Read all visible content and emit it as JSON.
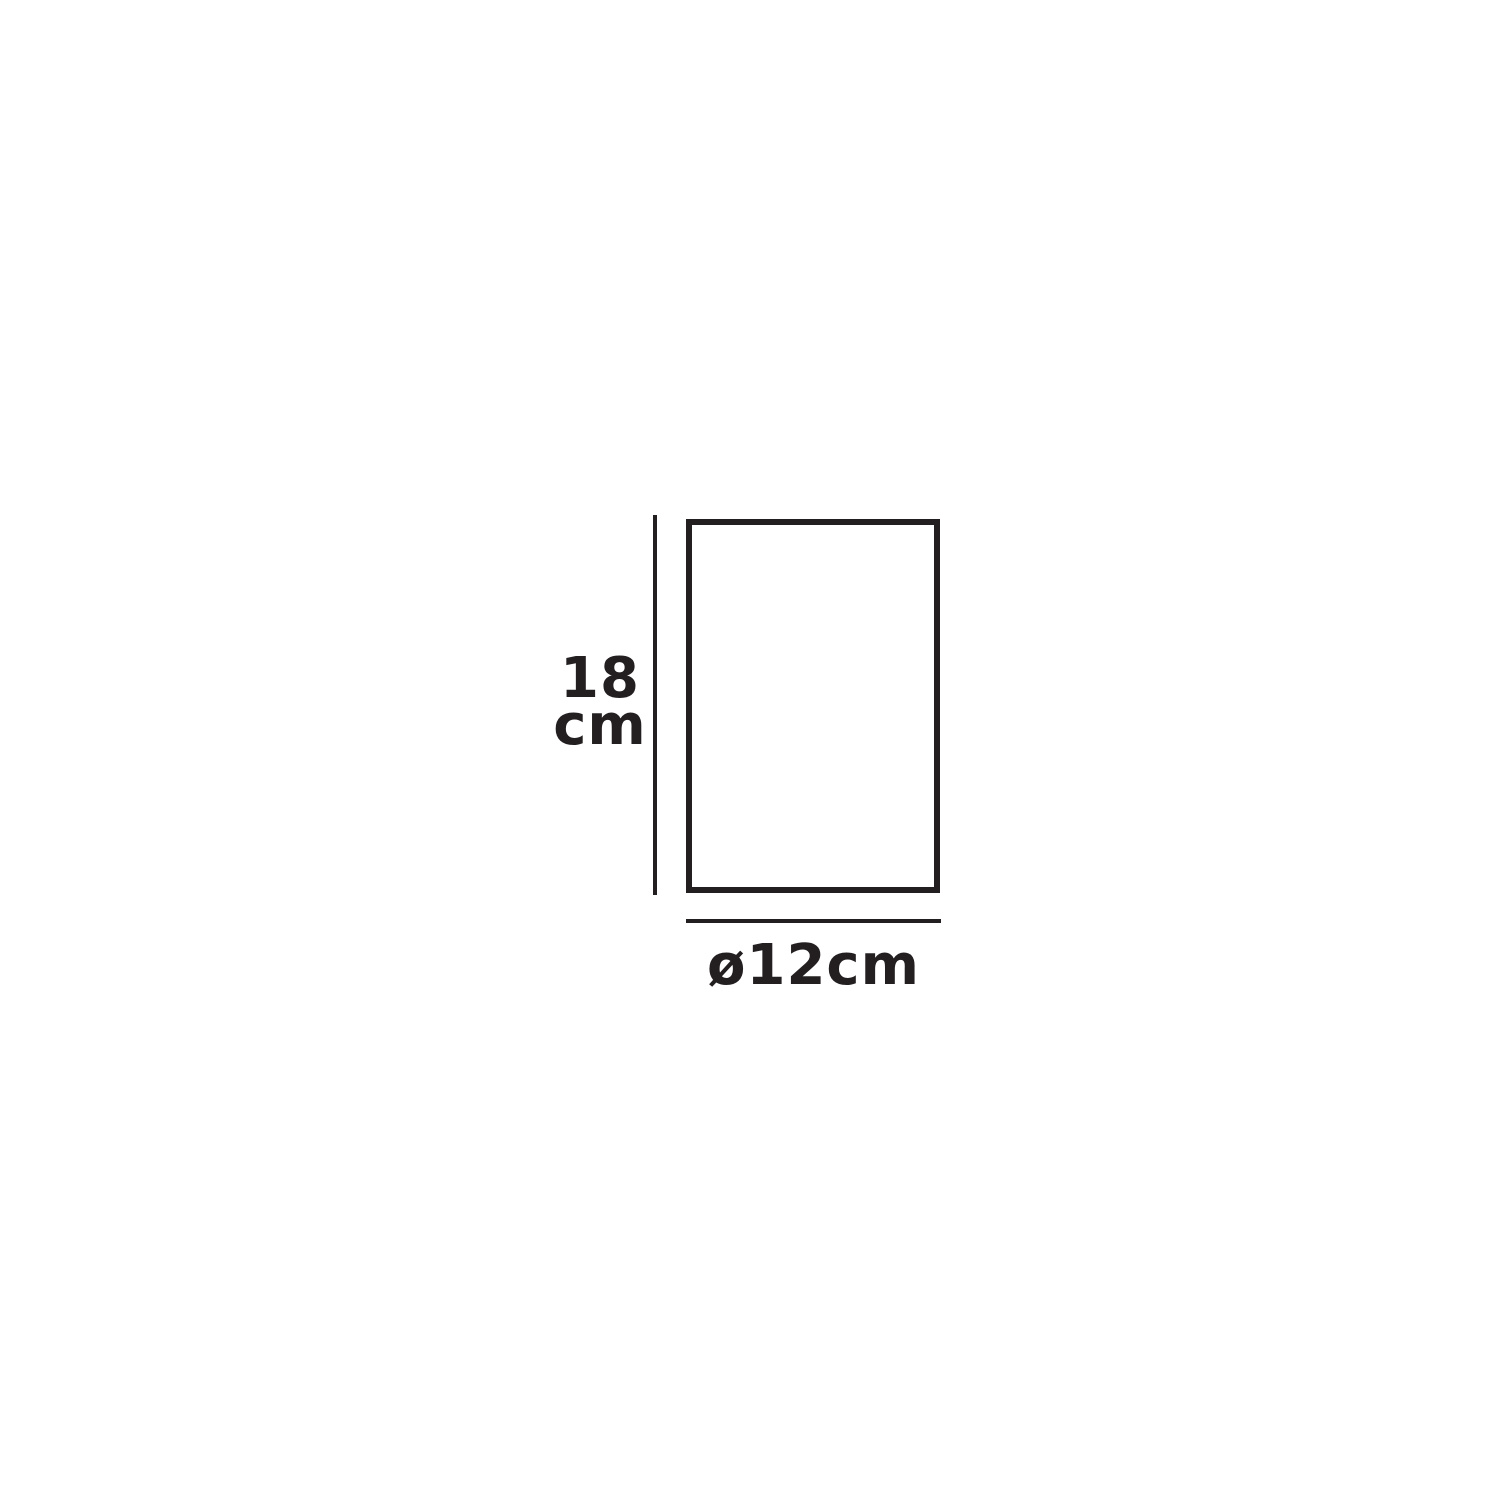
{
  "canvas": {
    "background_color": "#ffffff",
    "line_color": "#231f20"
  },
  "diagram": {
    "type": "product-dimension-diagram",
    "shape": "rectangle-outline",
    "height_dimension": {
      "label_line1": "18",
      "label_line2": "cm",
      "value": "18 cm"
    },
    "width_dimension": {
      "label": "ø12cm",
      "value": "12 cm diameter"
    }
  }
}
